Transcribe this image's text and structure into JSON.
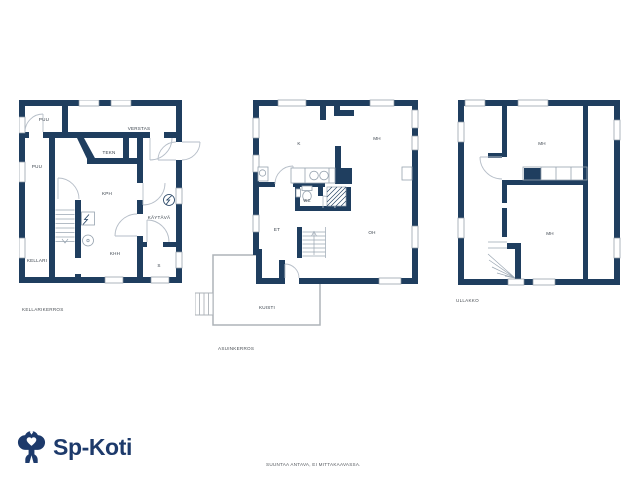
{
  "sheet": {
    "background": "#ffffff"
  },
  "colors": {
    "wall": "#1f3e5f",
    "door_arc": "#b6bec8",
    "fixture_outline": "#97a3af",
    "porch_outline": "#adb3b8",
    "room_text": "#39424c",
    "note_text": "#4a4f55",
    "logo": "#1d3a6b"
  },
  "branding": {
    "logo_text": "Sp-Koti",
    "logo_icon": "sp-koti-tree-icon"
  },
  "disclaimer": "SUUNTAA ANTAVA, EI MITTAKAAVASSA.",
  "floors": [
    {
      "label": "KELLARIKERROS",
      "rooms": [
        {
          "label": "PUU"
        },
        {
          "label": "VERSTAS"
        },
        {
          "label": "TEKN"
        },
        {
          "label": "PUU"
        },
        {
          "label": "KPH"
        },
        {
          "label": "KÄYTÄVÄ"
        },
        {
          "label": "KHH"
        },
        {
          "label": "KELLARI"
        },
        {
          "label": "S"
        }
      ]
    },
    {
      "label": "ASUINKERROS",
      "rooms": [
        {
          "label": "K"
        },
        {
          "label": "MH"
        },
        {
          "label": "WC"
        },
        {
          "label": "ET"
        },
        {
          "label": "OH"
        },
        {
          "label": "KUISTI"
        }
      ]
    },
    {
      "label": "ULLAKKO",
      "rooms": [
        {
          "label": "MH"
        },
        {
          "label": "MH"
        }
      ]
    }
  ]
}
